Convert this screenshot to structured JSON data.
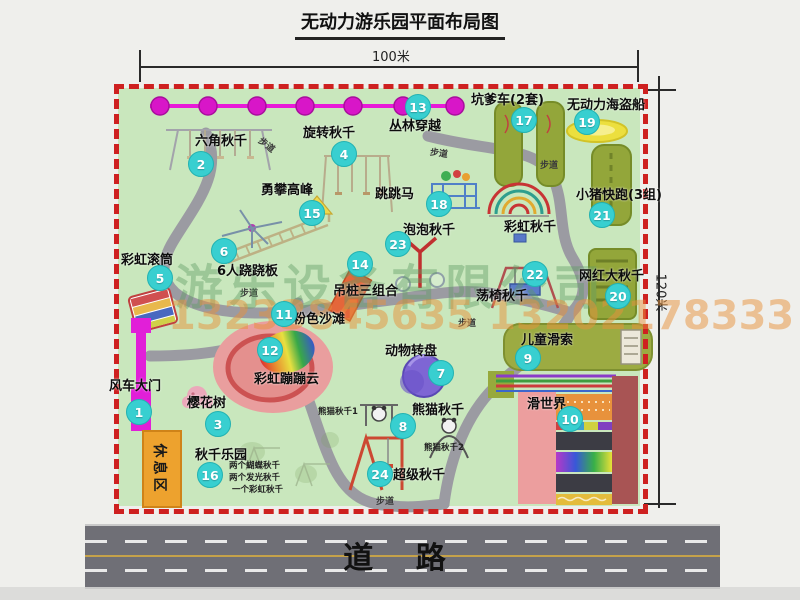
{
  "title": "无动力游乐园平面布局图",
  "dims": {
    "width": "100米",
    "height": "120米"
  },
  "road": {
    "label": "道 路"
  },
  "walkway": {
    "label": "步道"
  },
  "watermark": {
    "company": "游乐设备有限公司",
    "phone": "13233845635 13202178333"
  },
  "rest_area": {
    "label": "休息区"
  },
  "attractions": [
    {
      "num": "1",
      "name": "风车大门"
    },
    {
      "num": "2",
      "name": "六角秋千"
    },
    {
      "num": "3",
      "name": "樱花树"
    },
    {
      "num": "4",
      "name": "旋转秋千"
    },
    {
      "num": "5",
      "name": "彩虹滚筒"
    },
    {
      "num": "6",
      "name": "6人跷跷板"
    },
    {
      "num": "7",
      "name": "动物转盘"
    },
    {
      "num": "8",
      "name": "熊猫秋千"
    },
    {
      "num": "9",
      "name": "儿童滑索"
    },
    {
      "num": "10",
      "name": "滑世界"
    },
    {
      "num": "11",
      "name": "粉色沙滩"
    },
    {
      "num": "12",
      "name": "彩虹蹦蹦云"
    },
    {
      "num": "13",
      "name": "丛林穿越"
    },
    {
      "num": "14",
      "name": "吊桩三组合"
    },
    {
      "num": "15",
      "name": "勇攀高峰"
    },
    {
      "num": "16",
      "name": "秋千乐园"
    },
    {
      "num": "17",
      "name": "坑爹车(2套)"
    },
    {
      "num": "18",
      "name": "跳跳马"
    },
    {
      "num": "19",
      "name": "无动力海盗船"
    },
    {
      "num": "20",
      "name": "网红大秋千"
    },
    {
      "num": "21",
      "name": "小猪快跑(3组)"
    },
    {
      "num": "22",
      "name": "荡椅秋千"
    },
    {
      "num": "23",
      "name": "泡泡秋千"
    },
    {
      "num": "24",
      "name": "超级秋千"
    }
  ],
  "extra": {
    "rainbow_swing": "彩虹秋千",
    "panda_swing_1": "熊猫秋千1",
    "panda_swing_2": "熊猫秋千2",
    "swing_park_details": [
      "两个蝴蝶秋千",
      "两个发光秋千",
      "一个彩虹秋千"
    ]
  }
}
